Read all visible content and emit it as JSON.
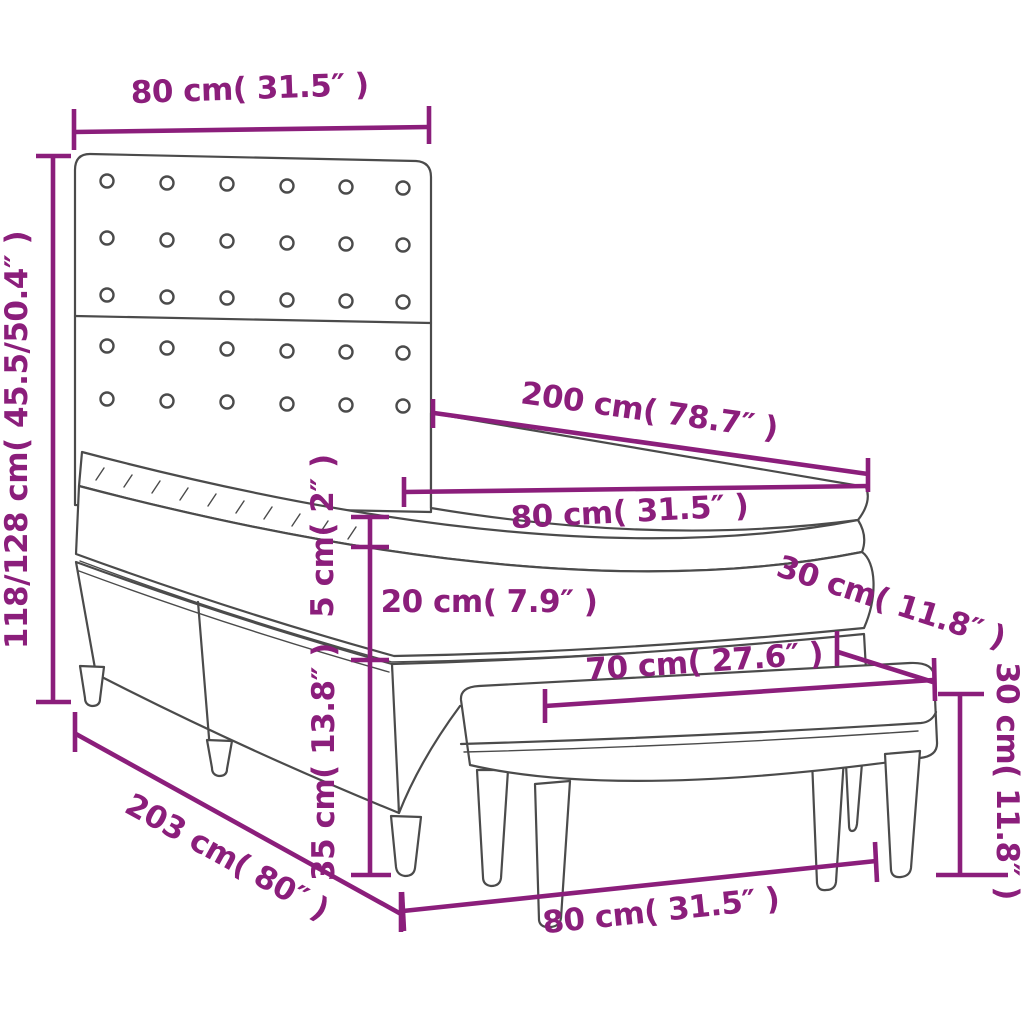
{
  "diagram": {
    "title": "box-spring-bed-with-bench-dimension-diagram",
    "accent_color": "#8B1E7B",
    "line_color": "#4B4B4B",
    "background": "#FFFFFF"
  },
  "dimensions": {
    "headboard_width": {
      "label": "80 cm( 31.5″ )",
      "cm": "80",
      "inch": "31.5"
    },
    "bed_height": {
      "label": "118/128 cm( 45.5/50.4″ )",
      "cm": "118/128",
      "inch": "45.5/50.4"
    },
    "mattress_length": {
      "label": "200 cm( 78.7″ )",
      "cm": "200",
      "inch": "78.7"
    },
    "mattress_width": {
      "label": "80 cm( 31.5″ )",
      "cm": "80",
      "inch": "31.5"
    },
    "topper_height": {
      "label": "5 cm( 2″ )",
      "cm": "5",
      "inch": "2"
    },
    "mattress_height": {
      "label": "20 cm( 7.9″ )",
      "cm": "20",
      "inch": "7.9"
    },
    "base_height": {
      "label": "35 cm( 13.8″ )",
      "cm": "35",
      "inch": "13.8"
    },
    "total_length": {
      "label": "203 cm( 80″ )",
      "cm": "203",
      "inch": "80"
    },
    "bench_length": {
      "label": "70 cm( 27.6″ )",
      "cm": "70",
      "inch": "27.6"
    },
    "bench_depth": {
      "label": "30 cm( 11.8″ )",
      "cm": "30",
      "inch": "11.8"
    },
    "bench_height": {
      "label": "30 cm( 11.8″ )",
      "cm": "30",
      "inch": "11.8"
    },
    "bench_width": {
      "label": "80 cm( 31.5″ )",
      "cm": "80",
      "inch": "31.5"
    }
  }
}
